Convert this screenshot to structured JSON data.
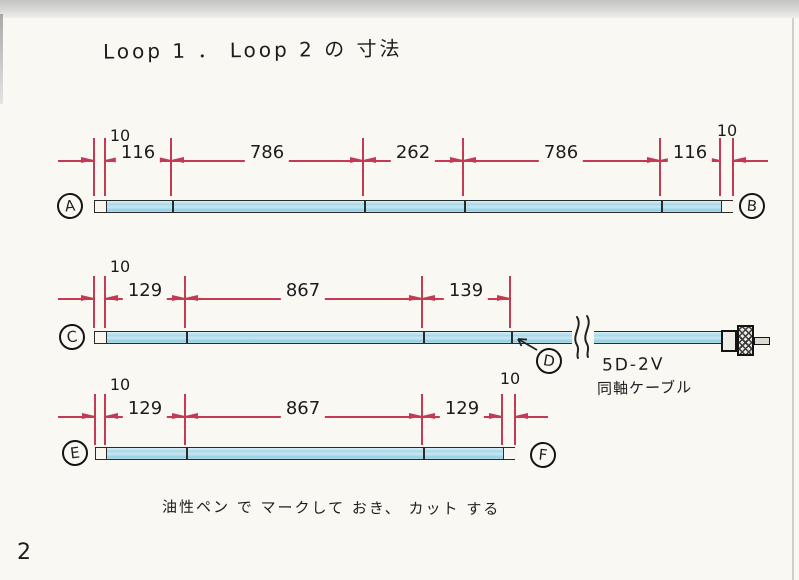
{
  "page": {
    "title": "Loop 1 ． Loop 2 の 寸法",
    "note": "油性ペン で マークして おき、 カット する",
    "page_number": "2"
  },
  "cable": {
    "type": "5D-2V",
    "name": "同軸ケーブル"
  },
  "loops": {
    "loop1": {
      "start": "A",
      "end": "B",
      "left_margin": "10",
      "right_margin": "10",
      "segments": [
        "116",
        "786",
        "262",
        "786",
        "116"
      ]
    },
    "loop2_top": {
      "start": "C",
      "feed_point": "D",
      "left_margin": "10",
      "segments": [
        "129",
        "867",
        "139"
      ]
    },
    "loop2_bottom": {
      "start": "E",
      "end": "F",
      "left_margin": "10",
      "right_margin": "10",
      "segments": [
        "129",
        "867",
        "129"
      ]
    }
  }
}
